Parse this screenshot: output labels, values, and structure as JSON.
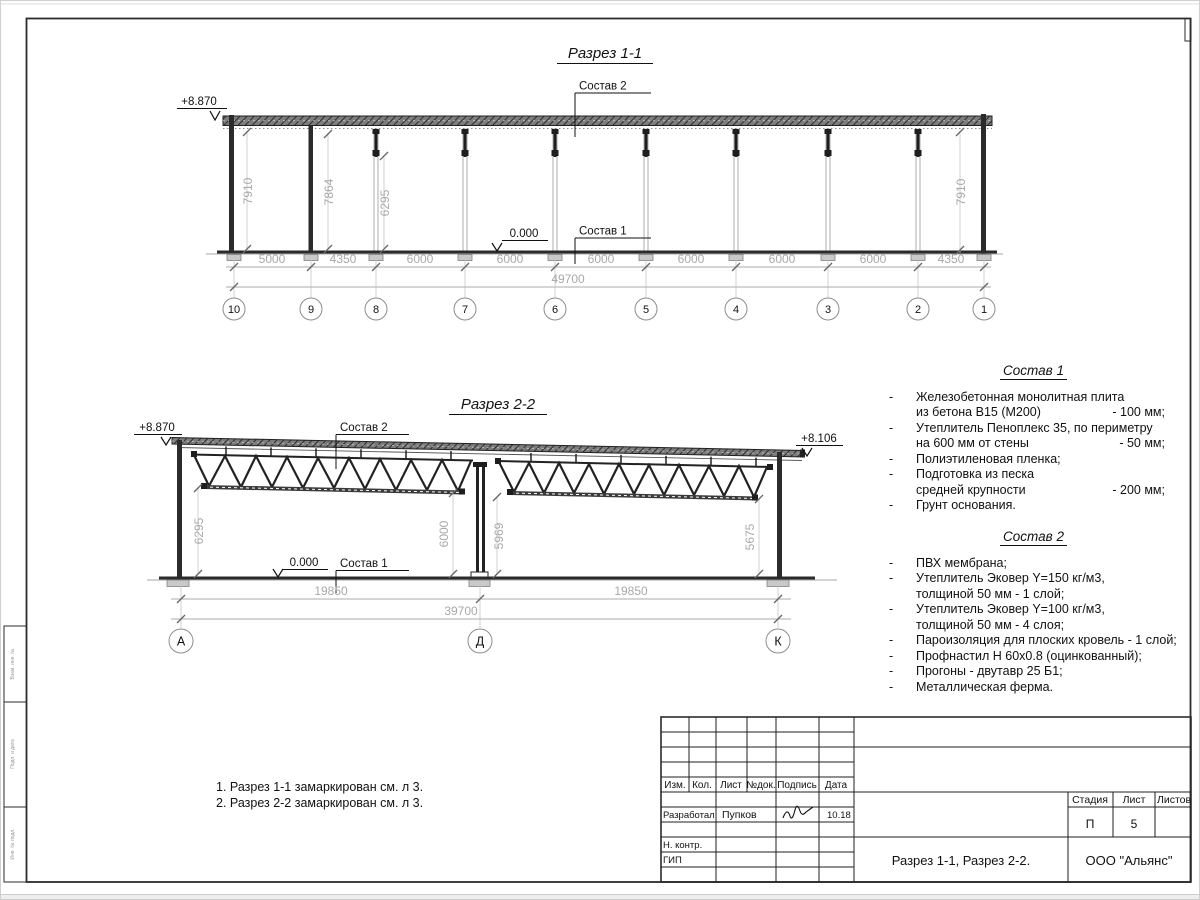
{
  "section1": {
    "title": "Разрез 1-1",
    "elevation_top": "+8.870",
    "zero_level": "0.000",
    "sostav1_label": "Состав 1",
    "sostav2_label": "Состав 2",
    "dims_vertical": [
      "7910",
      "7864",
      "6295",
      "7910"
    ],
    "dims_bottom": [
      "5000",
      "4350",
      "6000",
      "6000",
      "6000",
      "6000",
      "6000",
      "6000",
      "4350"
    ],
    "dim_total": "49700",
    "axes": [
      "10",
      "9",
      "8",
      "7",
      "6",
      "5",
      "4",
      "3",
      "2",
      "1"
    ]
  },
  "section2": {
    "title": "Разрез 2-2",
    "elevation_top": "+8.870",
    "elevation_right": "+8.106",
    "zero_level": "0.000",
    "sostav1_label": "Состав 1",
    "sostav2_label": "Состав 2",
    "dims_vertical": [
      "6295",
      "6000",
      "5969",
      "5675"
    ],
    "dims_bottom": [
      "19850",
      "19850"
    ],
    "dim_total": "39700",
    "axes": [
      "А",
      "Д",
      "К"
    ]
  },
  "sostav1": {
    "title": "Состав 1",
    "bullet": "-",
    "items": [
      {
        "text": "Железобетонная  монолитная плита",
        "text2": "из бетона В15 (М200)",
        "value": "- 100 мм;"
      },
      {
        "text": "Утеплитель Пеноплекс 35, по периметру",
        "text2": "на 600 мм от стены",
        "value": "- 50 мм;"
      },
      {
        "text": "Полиэтиленовая пленка;"
      },
      {
        "text": "Подготовка из песка",
        "text2": "средней крупности",
        "value": "- 200 мм;"
      },
      {
        "text": "Грунт основания."
      }
    ]
  },
  "sostav2": {
    "title": "Состав 2",
    "bullet": "-",
    "items": [
      {
        "text": "ПВХ мембрана;"
      },
      {
        "text": "Утеплитель Эковер Y=150 кг/м3,",
        "text2": "толщиной 50 мм - 1 слой;"
      },
      {
        "text": "Утеплитель Эковер Y=100 кг/м3,",
        "text2": "толщиной 50 мм - 4 слоя;"
      },
      {
        "text": "Пароизоляция для плоских кровель - 1 слой;"
      },
      {
        "text": "Профнастил Н 60х0.8 (оцинкованный);"
      },
      {
        "text": "Прогоны - двутавр 25 Б1;"
      },
      {
        "text": "Металлическая ферма."
      }
    ]
  },
  "notes": [
    "1. Разрез 1-1 замаркирован см. л 3.",
    "2. Разрез 2-2 замаркирован см. л 3."
  ],
  "titleblock": {
    "col_headers": [
      "Изм.",
      "Кол.",
      "Лист",
      "№док.",
      "Подпись",
      "Дата"
    ],
    "row_developed": {
      "label": "Разработал",
      "name": "Пупков",
      "date": "10.18"
    },
    "row_ncontrol": "Н. контр.",
    "row_gip": "ГИП",
    "stage_label": "Стадия",
    "sheet_label": "Лист",
    "sheets_label": "Листов",
    "stage": "П",
    "sheet_number": "5",
    "doc_title": "Разрез 1-1, Разрез 2-2.",
    "company": "ООО \"Альянс\""
  },
  "margin_stamps": [
    "Взам. инв. №",
    "Подп. и дата",
    "Инв. № подл."
  ]
}
